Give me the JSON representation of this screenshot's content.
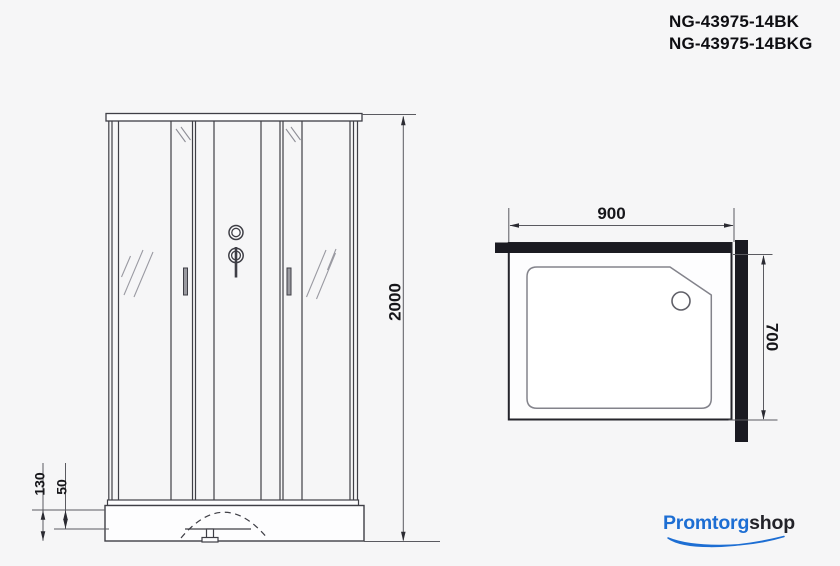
{
  "product": {
    "code_line1": "NG-43975-14BK",
    "code_line2": "NG-43975-14BKG"
  },
  "dimensions": {
    "overall_height": "2000",
    "width": "900",
    "depth": "700",
    "tray_height": "130",
    "tray_clearance": "50"
  },
  "logo": {
    "brand": "Promtorg",
    "suffix": "shop"
  },
  "colors": {
    "accent_blue": "#1d6ed3",
    "drawing_line": "#3f3f46",
    "wall_fill": "#1a1a21",
    "background": "#f6f6f7"
  }
}
